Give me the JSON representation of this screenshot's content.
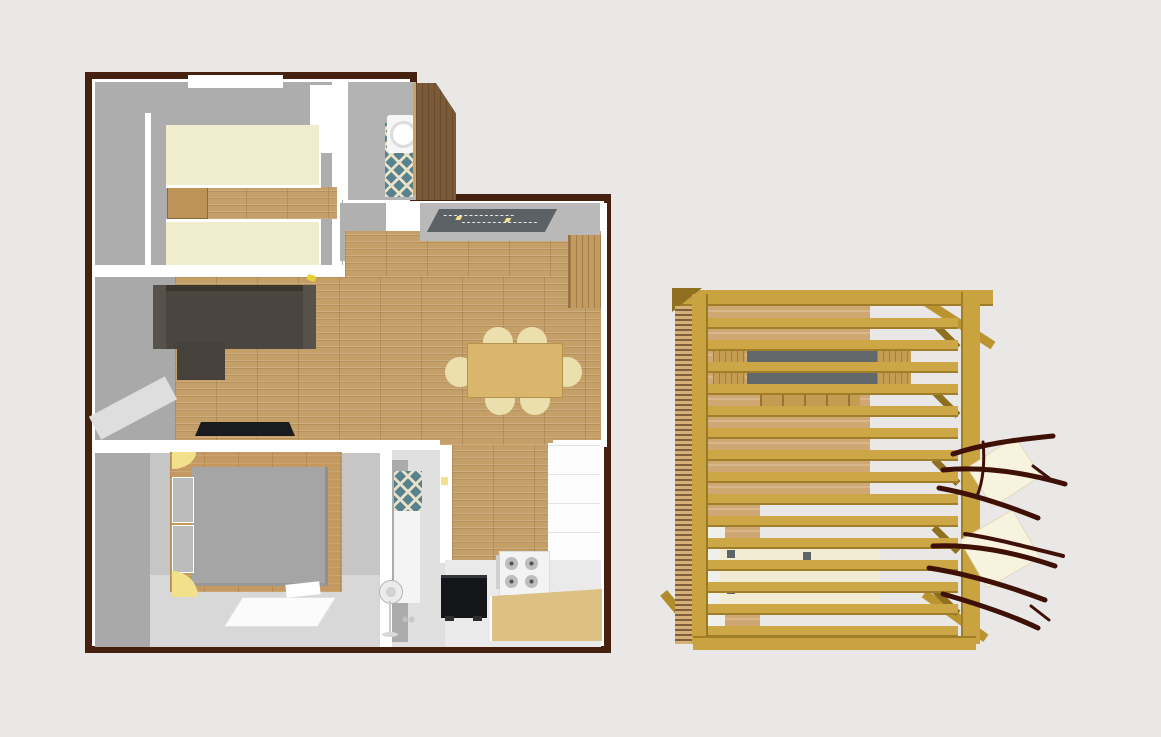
{
  "scene": {
    "description": "3D dollhouse-view rendering of an apartment floor plan (left) next to a slatted wooden pergola deck seen from above (right)",
    "visible_text": "none"
  },
  "colors": {
    "page_bg": "#e9e8e7",
    "outline": "#46210f",
    "wall_white": "#ffffff",
    "wall_gray": "#adadad",
    "wall_gray_dark": "#a9a9a9",
    "wall_gray_light": "#c6c6c6",
    "floor_light": "#d8d8d8",
    "wood": "#c59f68",
    "platform": "#c49a62",
    "bed_cream": "#efedcb",
    "nightstand": "#bd9357",
    "sofa": "#4a453e",
    "sofa_dark": "#3b372f",
    "sofa_light": "#56514a",
    "tv": "#1a1b1f",
    "table_wood": "#d9b66b",
    "chair_cream": "#ecdfae",
    "bed_gray": "#a5a5a5",
    "pillow": "#bcbcbc",
    "yellow": "#f2e18a",
    "tile_teal": "#57828e",
    "tile_cream": "#e9e2c9",
    "wardrobe_brown": "#7b5a39",
    "wardrobe_tan": "#c49a5f",
    "mat": "#5c6166",
    "appliance": "#141518",
    "stove": "#f3f3f3",
    "burner": "#bdbdbd",
    "counter": "#ddc083",
    "cabinet": "#fcfcfc",
    "gold": "#c9a340",
    "gold_dark": "#a07d28",
    "gold_deep": "#8f6f20",
    "gold_slat": "#cda645",
    "deck_tan": "#cfa773",
    "side_slat": "#d6b077",
    "side_slat_gap": "#7d5f3e",
    "table_gray": "#63686b",
    "bench": "#c59d52",
    "cushion": "#f3ecd4",
    "lounger": "#f8f3df",
    "branch": "#3f1106",
    "fan": "#ececec"
  },
  "floorplan": {
    "name": "apartment-plan",
    "rooms": [
      {
        "name": "twin-bedroom",
        "furniture": [
          "single bed",
          "single bed",
          "nightstand",
          "wood floor strip",
          "window"
        ]
      },
      {
        "name": "bathroom",
        "furniture": [
          "washing machine",
          "teal patterned tile floor",
          "corner wardrobe"
        ]
      },
      {
        "name": "entry-hall",
        "furniture": [
          "dark doormat with yellow markers"
        ]
      },
      {
        "name": "living-room",
        "furniture": [
          "dark corner sofa",
          "wall tv",
          "parquet floor",
          "small yellow object"
        ]
      },
      {
        "name": "dining-area",
        "furniture": [
          "wooden dining table",
          "six cream chairs",
          "tall wardrobe"
        ]
      },
      {
        "name": "double-bedroom",
        "furniture": [
          "gray double bed on wood platform",
          "two pillows",
          "two yellow corner lamps",
          "white desk"
        ]
      },
      {
        "name": "shower-room",
        "furniture": [
          "teal tiled shower",
          "standing fan",
          "sink items"
        ]
      },
      {
        "name": "kitchen",
        "furniture": [
          "black oven",
          "gas hob with four burners",
          "wooden counter",
          "white cabinet run",
          "yellow switch"
        ]
      }
    ]
  },
  "pergola": {
    "name": "pergola-deck",
    "roof_slats": 15,
    "left_wall": "dense horizontal slat screen",
    "furniture": [
      "gray picnic table with wooden benches",
      "row of stacked wooden chairs",
      "outdoor sofa with cream cushions",
      "two cream sun loungers",
      "bare maroon branches"
    ]
  }
}
